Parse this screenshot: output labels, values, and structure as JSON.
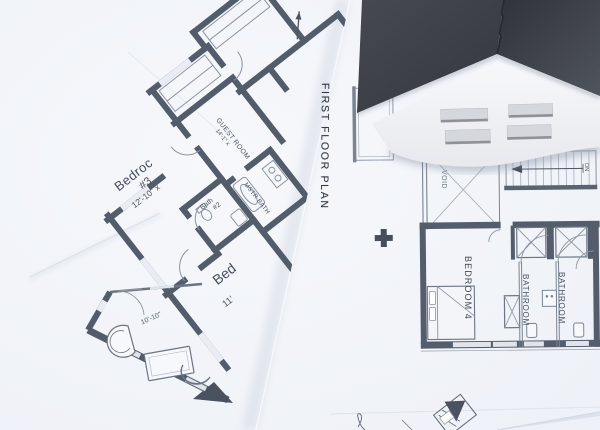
{
  "scene": {
    "description": "Overlapping architectural floor plan sheets with a folded paper house model",
    "colors": {
      "background": "#eef1f7",
      "paper": "#f7f9fc",
      "wall_dark": "#535c6a",
      "thin_line": "#9aa2b0",
      "label_text": "#424a57",
      "roof_dark": "#33363c",
      "roof_mid": "#45494f",
      "house_wall": "#f2f3f6",
      "window_slot": "#d4d7dc"
    }
  },
  "first_floor_sheet": {
    "title": "FIRST FLOOR PLAN",
    "void_label": "VOID",
    "stairs_label": "DN",
    "bedroom4": "BEDROOM 4",
    "bathroom1": "BATHROOM",
    "bathroom2": "BATHROOM"
  },
  "bedroom_sheet": {
    "bedroom3_name": "Bedroc",
    "bedroom3_number": "#3",
    "bedroom3_dim": "12'-10\" x",
    "guest_name": "GUEST ROOM",
    "guest_dim": "14'-1\" x",
    "mstr_bath": "MSTR BATH",
    "bath2_name": "Bath",
    "bath2_number": "#2",
    "bed_partial": "Bed",
    "bed_dim": "11'"
  },
  "detail_sheet": {
    "dim": "10'-10\""
  }
}
